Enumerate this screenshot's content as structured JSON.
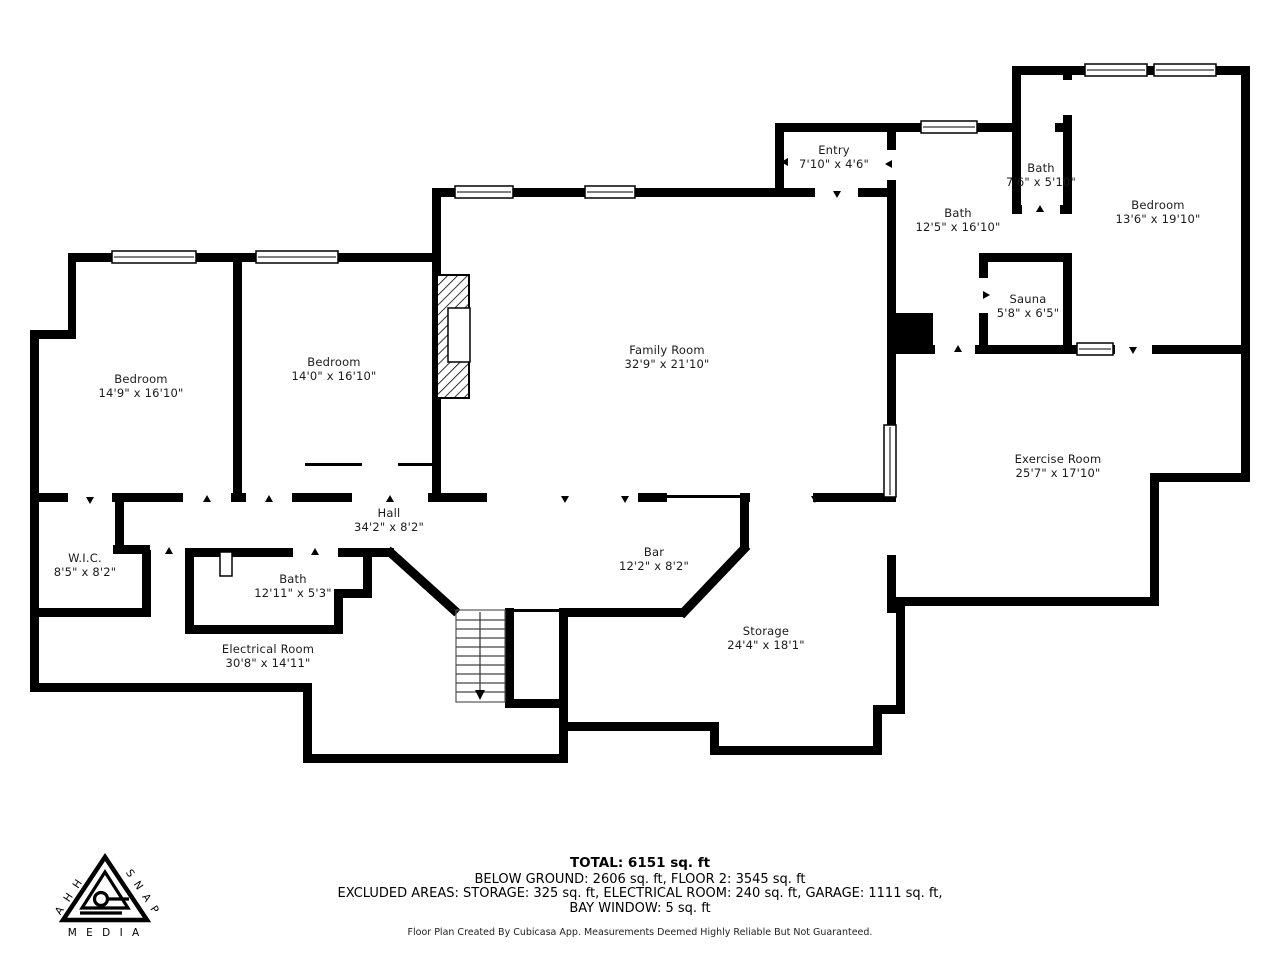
{
  "rooms": [
    {
      "id": "entry",
      "name": "Entry",
      "dims": "7'10\" x 4'6\""
    },
    {
      "id": "bath-main",
      "name": "Bath",
      "dims": "12'5\" x 16'10\""
    },
    {
      "id": "bath-small",
      "name": "Bath",
      "dims": "7'6\" x 5'10\""
    },
    {
      "id": "bedroom-top-right",
      "name": "Bedroom",
      "dims": "13'6\" x 19'10\""
    },
    {
      "id": "sauna",
      "name": "Sauna",
      "dims": "5'8\" x 6'5\""
    },
    {
      "id": "family-room",
      "name": "Family Room",
      "dims": "32'9\" x 21'10\""
    },
    {
      "id": "bedroom-left",
      "name": "Bedroom",
      "dims": "14'9\" x 16'10\""
    },
    {
      "id": "bedroom-mid",
      "name": "Bedroom",
      "dims": "14'0\" x 16'10\""
    },
    {
      "id": "exercise-room",
      "name": "Exercise Room",
      "dims": "25'7\" x 17'10\""
    },
    {
      "id": "hall",
      "name": "Hall",
      "dims": "34'2\" x 8'2\""
    },
    {
      "id": "wic",
      "name": "W.I.C.",
      "dims": "8'5\" x 8'2\""
    },
    {
      "id": "bath-lower",
      "name": "Bath",
      "dims": "12'11\" x 5'3\""
    },
    {
      "id": "bar",
      "name": "Bar",
      "dims": "12'2\" x 8'2\""
    },
    {
      "id": "storage",
      "name": "Storage",
      "dims": "24'4\" x 18'1\""
    },
    {
      "id": "electrical-room",
      "name": "Electrical Room",
      "dims": "30'8\" x 14'11\""
    }
  ],
  "footer": {
    "total": "TOTAL: 6151 sq. ft",
    "floors": "BELOW GROUND: 2606 sq. ft, FLOOR 2: 3545 sq. ft",
    "excluded1": "EXCLUDED AREAS: STORAGE: 325 sq. ft, ELECTRICAL ROOM: 240 sq. ft, GARAGE: 1111 sq. ft,",
    "excluded2": "BAY WINDOW: 5 sq. ft",
    "disclaimer": "Floor Plan Created By Cubicasa App. Measurements Deemed Highly Reliable But Not Guaranteed."
  },
  "logo": {
    "left": "A H H",
    "right": "S N A P",
    "bottom": "M E D I A"
  },
  "colors": {
    "wall": "#000000",
    "background": "#ffffff",
    "label_text": "#1b1b1b"
  }
}
